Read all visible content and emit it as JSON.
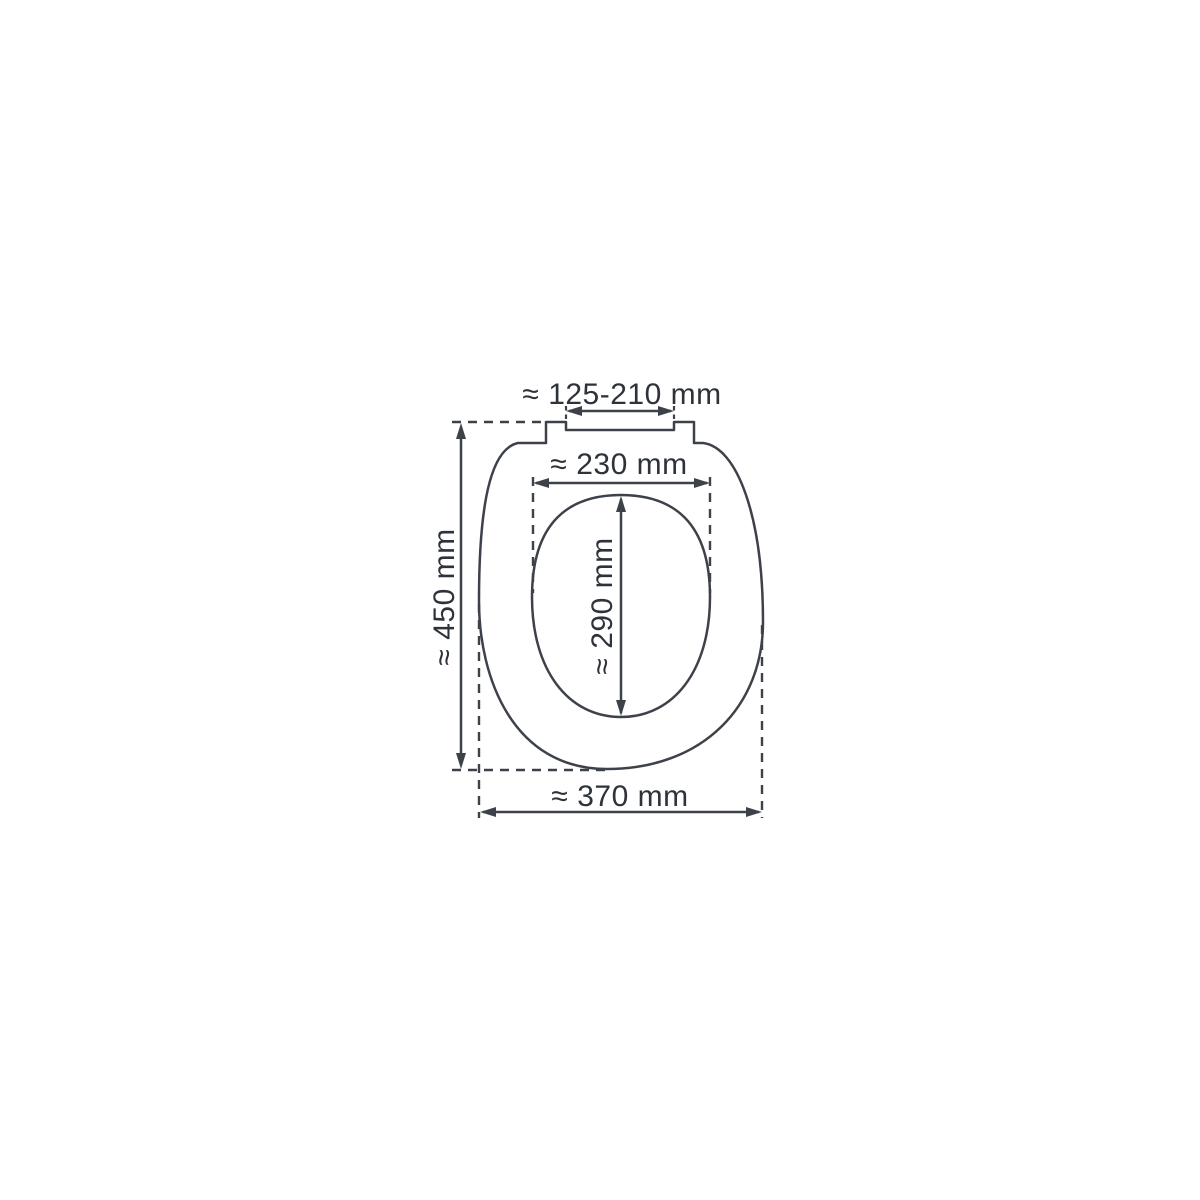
{
  "colors": {
    "background": "#ffffff",
    "line": "#3d424a",
    "text": "#2e323a"
  },
  "dimensions": {
    "hinge_width": {
      "label": "≈ 125-210 mm",
      "min_mm": 125,
      "max_mm": 210
    },
    "inner_width": {
      "label": "≈ 230 mm",
      "mm": 230
    },
    "inner_depth": {
      "label": "≈ 290 mm",
      "mm": 290
    },
    "outer_depth": {
      "label": "≈ 450 mm",
      "mm": 450
    },
    "outer_width": {
      "label": "≈ 370 mm",
      "mm": 370
    }
  }
}
